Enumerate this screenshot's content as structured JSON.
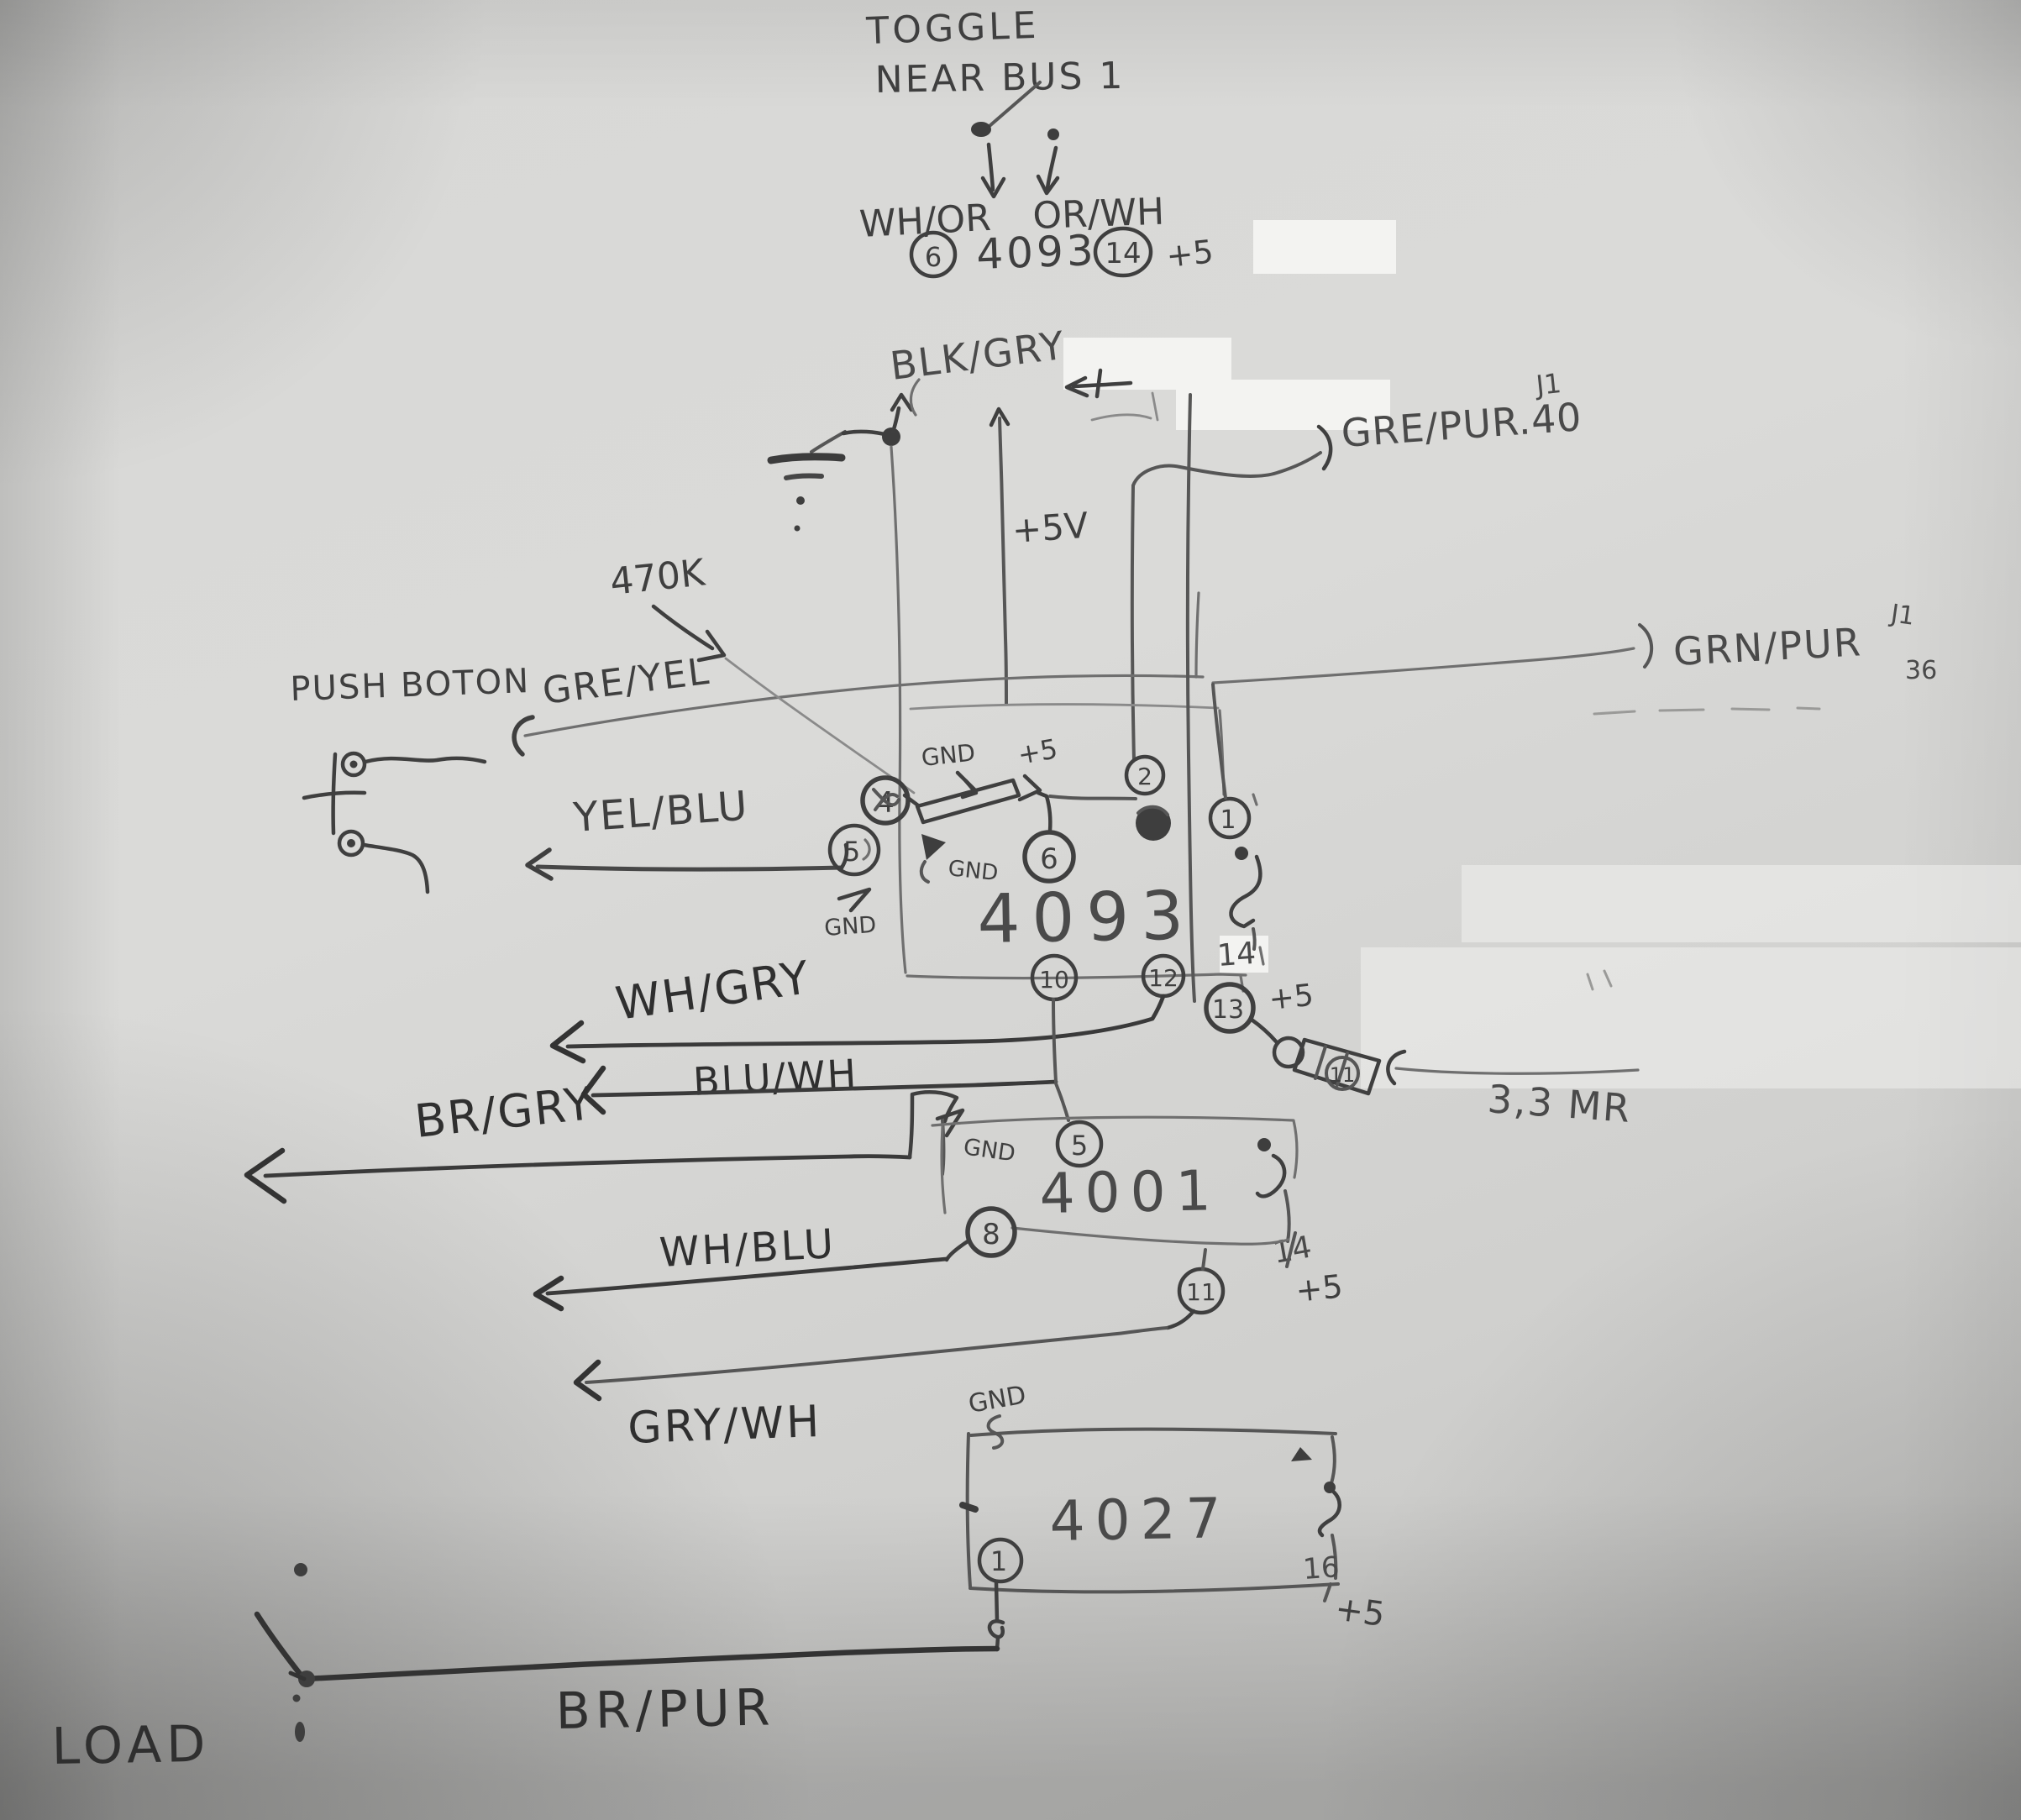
{
  "colors": {
    "paper": "#d6d6d4",
    "pencil": "#3f3f3f",
    "pencil_light": "#7a7a7a",
    "ink": "#2f2f2f"
  },
  "toggle": {
    "note_line1": "TOGGLE",
    "note_line2": "NEAR BUS 1",
    "wire_left": "WH/OR",
    "wire_right": "OR/WH",
    "dest_pin_left": "6",
    "dest_chip": "4093",
    "dest_pin_right": "14",
    "dest_supply": "+5"
  },
  "top": {
    "blk_gry": "BLK/GRY",
    "plus5v": "+5V",
    "r470k": "470K",
    "gre_yel": "GRE/YEL",
    "gre_pur": "GRE/PUR.40",
    "gre_pur_conn": "J1",
    "grn_pur": "GRN/PUR",
    "grn_pur_conn": "J1",
    "grn_pur_pin": "36"
  },
  "push_button": {
    "label": "PUSH BOTON",
    "yel_blu": "YEL/BLU"
  },
  "ic4093": {
    "name": "4093",
    "gnd_top": "GND",
    "plus5_top": "+5",
    "pin4": "4",
    "pin5": "5",
    "pin6": "6",
    "pin2": "2",
    "pin1": "1",
    "pin10": "10",
    "pin12": "12",
    "pin13": "13",
    "pin14": "14",
    "pin11": "11",
    "plus5_right": "+5",
    "plus5_13": "+5",
    "gnd_mid": "GND",
    "gnd_bot": "GND",
    "r33": "3,3 MR"
  },
  "left_labels": {
    "wh_gry": "WH/GRY",
    "blu_wh": "BLU/WH",
    "br_gry": "BR/GRY",
    "wh_blu": "WH/BLU",
    "gry_wh": "GRY/WH"
  },
  "ic4001": {
    "name": "4001",
    "gnd": "GND",
    "pin5": "5",
    "pin8": "8",
    "pin11": "11",
    "pin14": "14",
    "plus5": "+5"
  },
  "ic4027": {
    "name": "4027",
    "gnd": "GND",
    "pin1": "1",
    "pin16": "16",
    "plus5": "+5"
  },
  "bottom": {
    "load": "LOAD",
    "br_pur": "BR/PUR"
  }
}
